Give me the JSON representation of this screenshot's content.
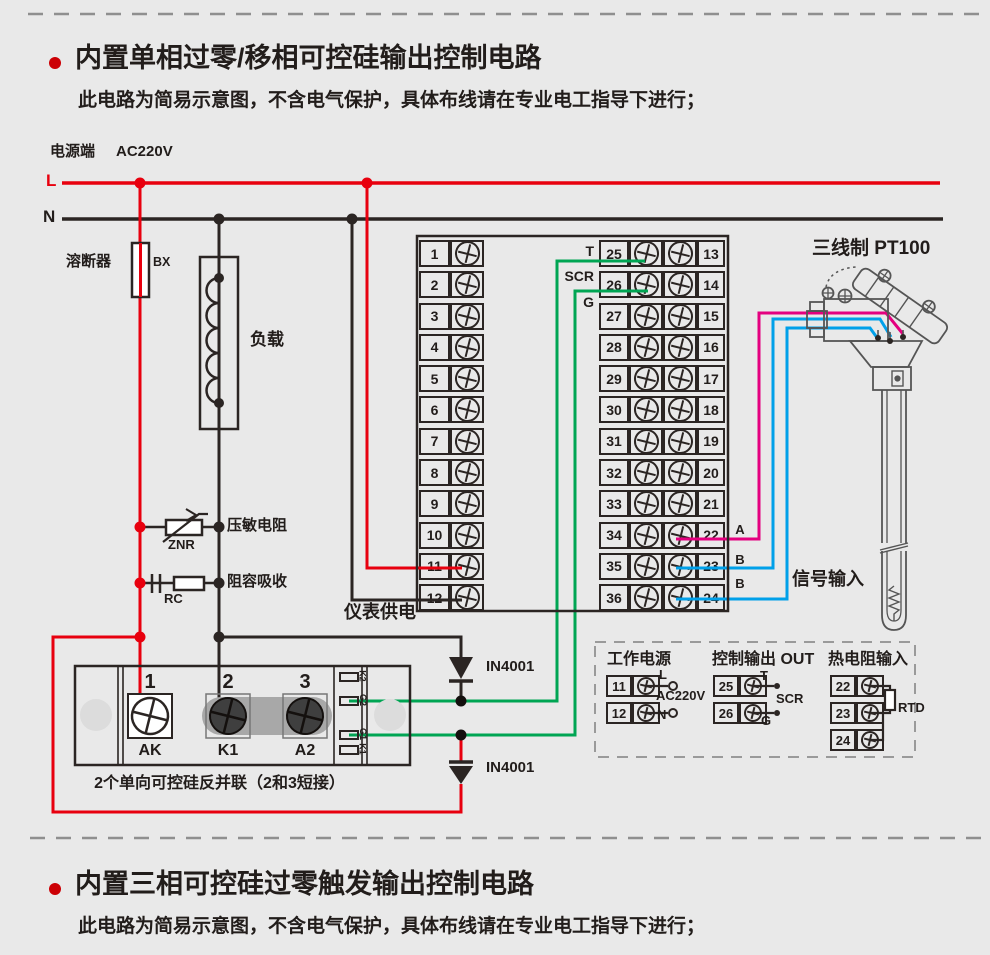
{
  "colors": {
    "bg": "#e9e9e9",
    "red": "#e8000e",
    "dark": "#2b2523",
    "green": "#00a553",
    "blue": "#00a0e9",
    "pink": "#e4007f",
    "gray_dash": "#8f8f8f"
  },
  "section_top": {
    "title": "内置单相过零/移相可控硅输出控制电路",
    "subtitle": "此电路为简易示意图，不含电气保护，具体布线请在专业电工指导下进行；"
  },
  "section_bottom": {
    "title": "内置三相可控硅过零触发输出控制电路",
    "subtitle": "此电路为简易示意图，不含电气保护，具体布线请在专业电工指导下进行；"
  },
  "power": {
    "label": "电源端",
    "voltage": "AC220V",
    "line_l": "L",
    "line_n": "N"
  },
  "components": {
    "fuse_label": "溶断器",
    "fuse_code": "BX",
    "load_label": "负载",
    "varistor_label": "压敏电阻",
    "varistor_code": "ZNR",
    "snubber_label": "阻容吸收",
    "snubber_code": "RC",
    "meter_supply": "仪表供电",
    "diode_top": "IN4001",
    "diode_bottom": "IN4001"
  },
  "scr_module": {
    "terminal_numbers": [
      "1",
      "2",
      "3"
    ],
    "terminal_names": [
      "AK",
      "K1",
      "A2"
    ],
    "strip_labels": [
      "K2",
      "G2",
      "G1",
      "K1"
    ],
    "caption": "2个单向可控硅反并联（2和3短接）"
  },
  "terminal_block": {
    "left": [
      "1",
      "2",
      "3",
      "4",
      "5",
      "6",
      "7",
      "8",
      "9",
      "10",
      "11",
      "12"
    ],
    "mid": [
      "25",
      "26",
      "27",
      "28",
      "29",
      "30",
      "31",
      "32",
      "33",
      "34",
      "35",
      "36"
    ],
    "right": [
      "13",
      "14",
      "15",
      "16",
      "17",
      "18",
      "19",
      "20",
      "21",
      "22",
      "23",
      "24"
    ],
    "out_t": "T",
    "out_scr": "SCR",
    "out_g": "G"
  },
  "sensor": {
    "title": "三线制 PT100",
    "signal_label": "信号输入",
    "wire_a": "A",
    "wire_b1": "B",
    "wire_b2": "B"
  },
  "legend": {
    "power": {
      "title": "工作电源",
      "row1": "11",
      "row2": "12",
      "l": "L",
      "voltage": "AC220V",
      "n": "N"
    },
    "output": {
      "title": "控制输出 OUT",
      "row1": "25",
      "row2": "26",
      "t": "T",
      "scr": "SCR",
      "g": "G"
    },
    "rtd": {
      "title": "热电阻输入",
      "row1": "22",
      "row2": "23",
      "row3": "24",
      "label": "RTD"
    }
  }
}
